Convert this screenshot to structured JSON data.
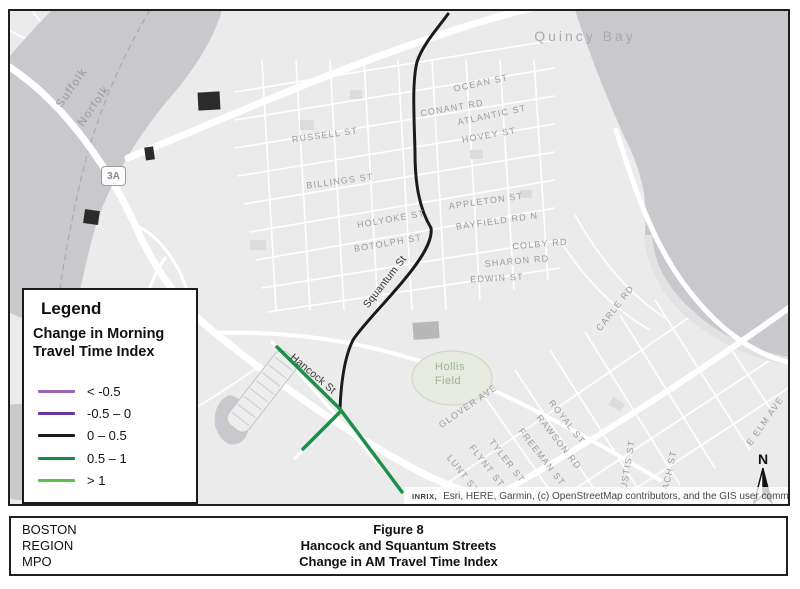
{
  "colors": {
    "land": "#ebebeb",
    "water": "#c9c9cd",
    "road": "#ffffff",
    "route_black": "#1b1b1b",
    "route_green": "#1b9048",
    "legend_lt_neg05": "#9e63b5",
    "legend_neg05_0": "#6a35a3",
    "legend_0_05": "#1a1a1a",
    "legend_05_1": "#158c43",
    "legend_gt_1": "#58c04d"
  },
  "map": {
    "route_shield": "3A",
    "north_label": "N",
    "attribution_prefix": "INRIX,",
    "attribution_text": "Esri, HERE, Garmin, (c) OpenStreetMap contributors, and the GIS user community",
    "water_labels": [
      {
        "text": "Quincy Bay",
        "x": 575,
        "y": 25,
        "rot": 0
      }
    ],
    "county_labels": [
      {
        "text": "Suffolk",
        "x": 62,
        "y": 77,
        "rot": -55
      },
      {
        "text": "Norfolk",
        "x": 84,
        "y": 95,
        "rot": -55
      }
    ],
    "area_labels": [
      {
        "text": "Hollis",
        "x": 440,
        "y": 356,
        "rot": 0
      },
      {
        "text": "Field",
        "x": 438,
        "y": 370,
        "rot": 0
      }
    ],
    "route_labels": [
      {
        "text": "Squantum St",
        "x": 375,
        "y": 271,
        "rot": -52
      },
      {
        "text": "Hancock St",
        "x": 303,
        "y": 363,
        "rot": 40
      }
    ],
    "street_labels": [
      {
        "text": "OCEAN ST",
        "x": 471,
        "y": 72,
        "rot": -12
      },
      {
        "text": "CONANT RD",
        "x": 442,
        "y": 97,
        "rot": -10
      },
      {
        "text": "ATLANTIC ST",
        "x": 482,
        "y": 104,
        "rot": -12
      },
      {
        "text": "HOVEY ST",
        "x": 479,
        "y": 124,
        "rot": -10
      },
      {
        "text": "RUSSELL ST",
        "x": 315,
        "y": 124,
        "rot": -8
      },
      {
        "text": "BILLINGS ST",
        "x": 330,
        "y": 170,
        "rot": -8
      },
      {
        "text": "HOLYOKE ST",
        "x": 381,
        "y": 208,
        "rot": -10
      },
      {
        "text": "APPLETON ST",
        "x": 476,
        "y": 190,
        "rot": -8
      },
      {
        "text": "BOTOLPH ST",
        "x": 378,
        "y": 232,
        "rot": -10
      },
      {
        "text": "BAYFIELD RD N",
        "x": 487,
        "y": 210,
        "rot": -8
      },
      {
        "text": "COLBY RD",
        "x": 530,
        "y": 233,
        "rot": -5
      },
      {
        "text": "SHARON RD",
        "x": 507,
        "y": 250,
        "rot": -5
      },
      {
        "text": "EDWIN ST",
        "x": 487,
        "y": 267,
        "rot": -3
      },
      {
        "text": "CARLE RD",
        "x": 605,
        "y": 297,
        "rot": -52
      },
      {
        "text": "GLOVER AVE",
        "x": 458,
        "y": 395,
        "rot": -35
      },
      {
        "text": "ROYAL ST",
        "x": 557,
        "y": 411,
        "rot": 52
      },
      {
        "text": "RAWSON RD",
        "x": 549,
        "y": 431,
        "rot": 52
      },
      {
        "text": "FREEMAN ST",
        "x": 532,
        "y": 446,
        "rot": 52
      },
      {
        "text": "TYLER ST",
        "x": 497,
        "y": 450,
        "rot": 52
      },
      {
        "text": "FLYNT ST",
        "x": 477,
        "y": 455,
        "rot": 52
      },
      {
        "text": "LUNT ST",
        "x": 453,
        "y": 463,
        "rot": 52
      },
      {
        "text": "EUSTIS ST",
        "x": 617,
        "y": 457,
        "rot": -80
      },
      {
        "text": "BEACH ST",
        "x": 658,
        "y": 466,
        "rot": -78
      },
      {
        "text": "E ELM AVE",
        "x": 755,
        "y": 410,
        "rot": -55
      }
    ]
  },
  "legend": {
    "title": "Legend",
    "subtitle": "Change in Morning Travel Time Index",
    "items": [
      {
        "label": "< -0.5",
        "color": "#9e63b5"
      },
      {
        "label": "-0.5 – 0",
        "color": "#6a35a3"
      },
      {
        "label": "0 – 0.5",
        "color": "#1a1a1a"
      },
      {
        "label": "0.5 – 1",
        "color": "#158c43"
      },
      {
        "label": "> 1",
        "color": "#58c04d"
      }
    ]
  },
  "caption": {
    "org_lines": [
      "BOSTON",
      "REGION",
      "MPO"
    ],
    "title_lines": [
      "Figure 8",
      "Hancock and Squantum Streets",
      "Change in AM Travel Time Index"
    ]
  }
}
